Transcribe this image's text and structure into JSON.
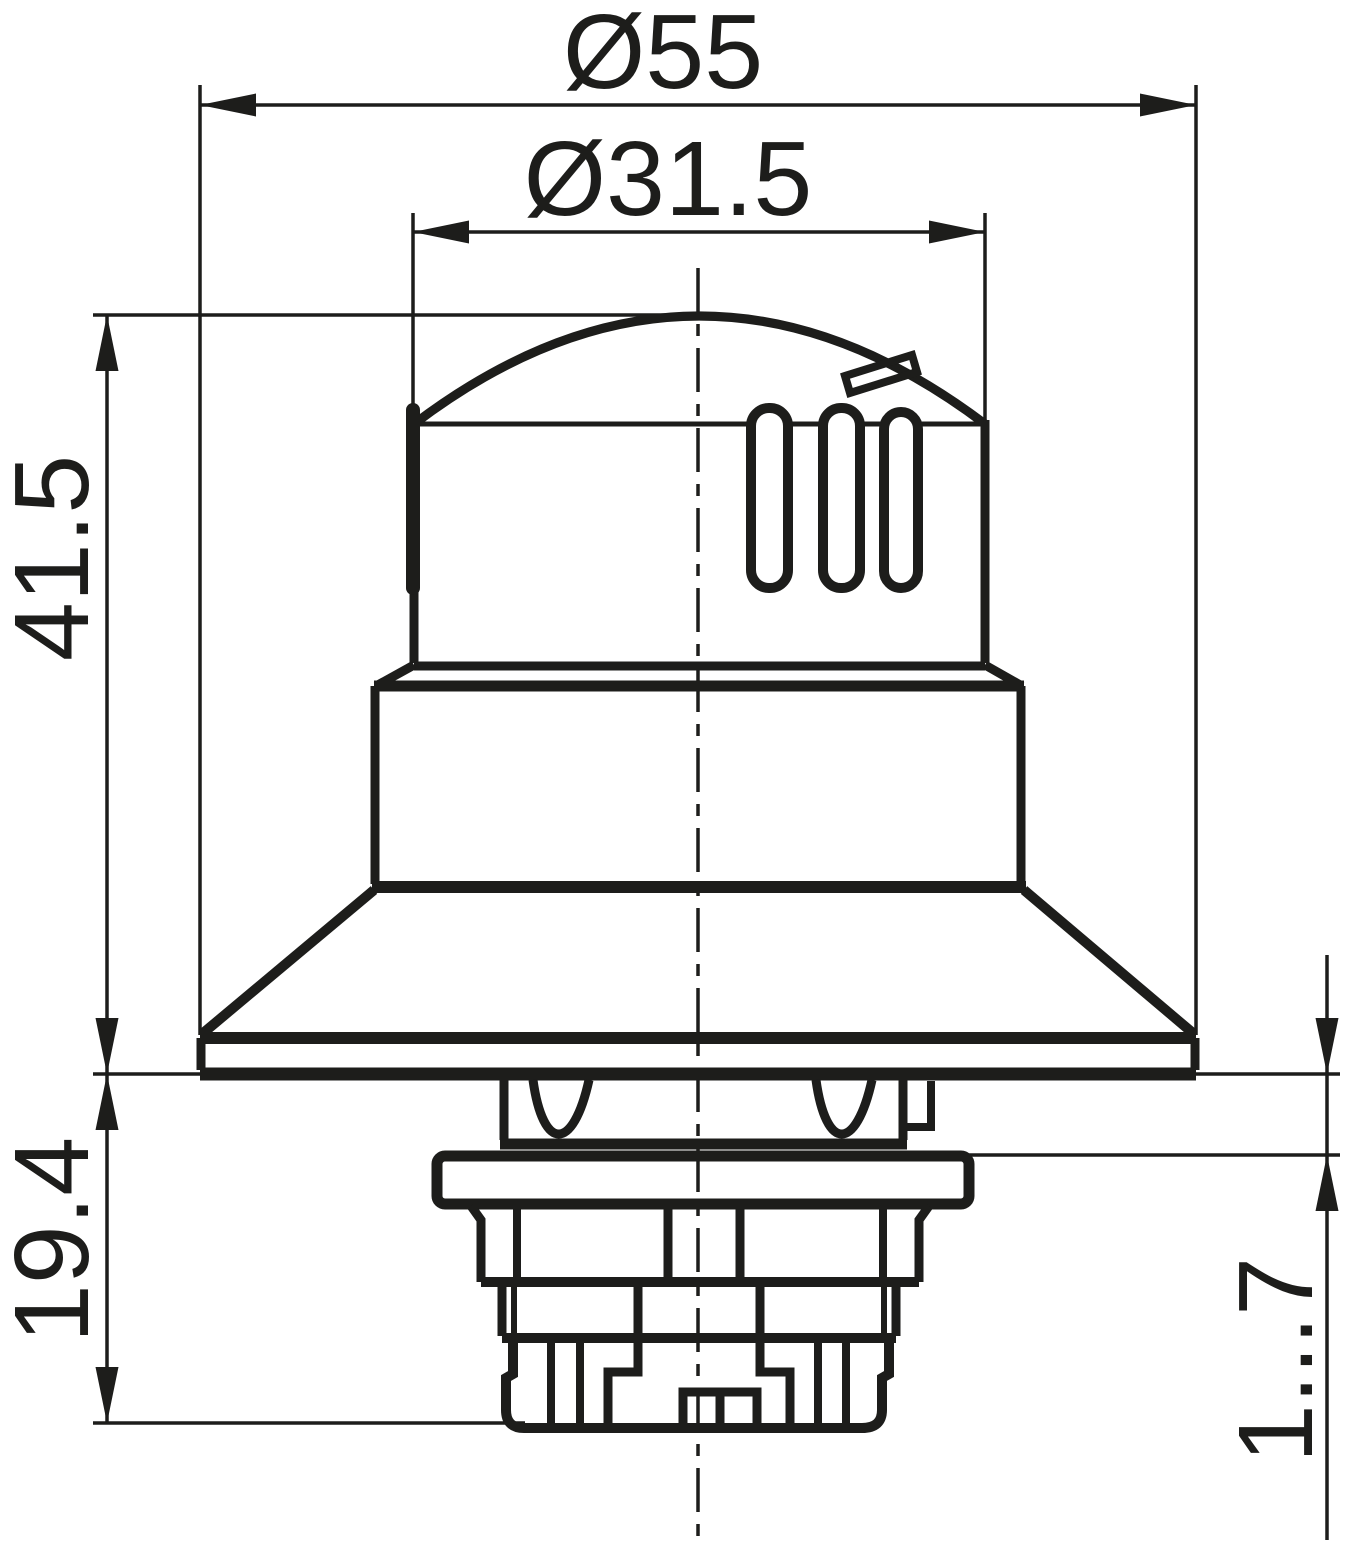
{
  "drawing": {
    "background_color": "#ffffff",
    "line_color": "#1d1d1b",
    "type_label": "technical-dimension-drawing"
  },
  "dimensions": {
    "outer_diameter": {
      "label": "Ø55"
    },
    "head_diameter": {
      "label": "Ø31.5"
    },
    "height_above_panel": {
      "label": "41.5"
    },
    "depth_below_panel": {
      "label": "19.4"
    },
    "panel_thickness_range": {
      "label": "1...7"
    }
  }
}
